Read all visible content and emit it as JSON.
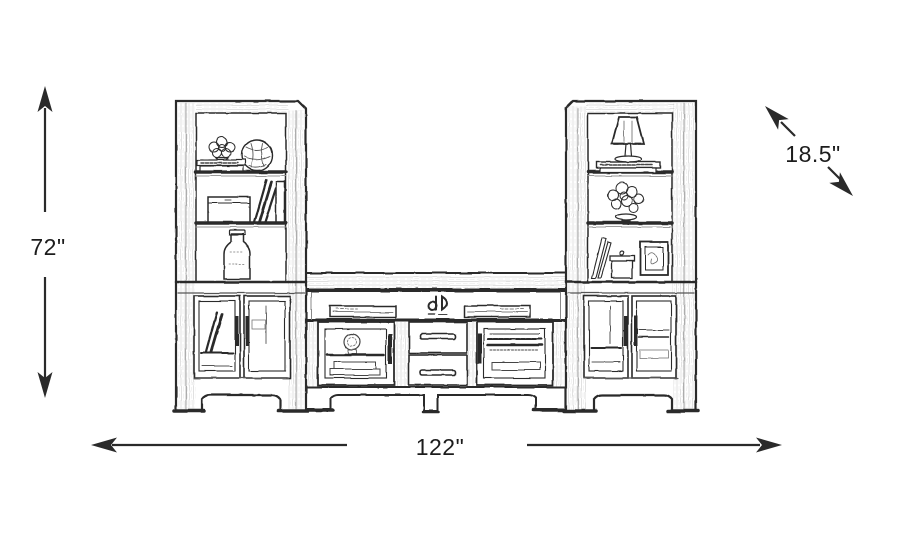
{
  "page": {
    "title": "Furniture dimensions diagram",
    "colors": {
      "background": "#ffffff",
      "line": "#2a2a2a",
      "label_text": "#1c1c1c"
    }
  },
  "sketch": {
    "description": "Pencil-style line drawing of a 3-piece entertainment wall unit: two bookcase piers with glass-door base cabinets flanking a TV console that has an open media shelf, two glass doors and two center drawers"
  },
  "dimensions": {
    "height": {
      "label": "72\""
    },
    "width": {
      "label": "122\""
    },
    "depth": {
      "label": "18.5\""
    }
  }
}
